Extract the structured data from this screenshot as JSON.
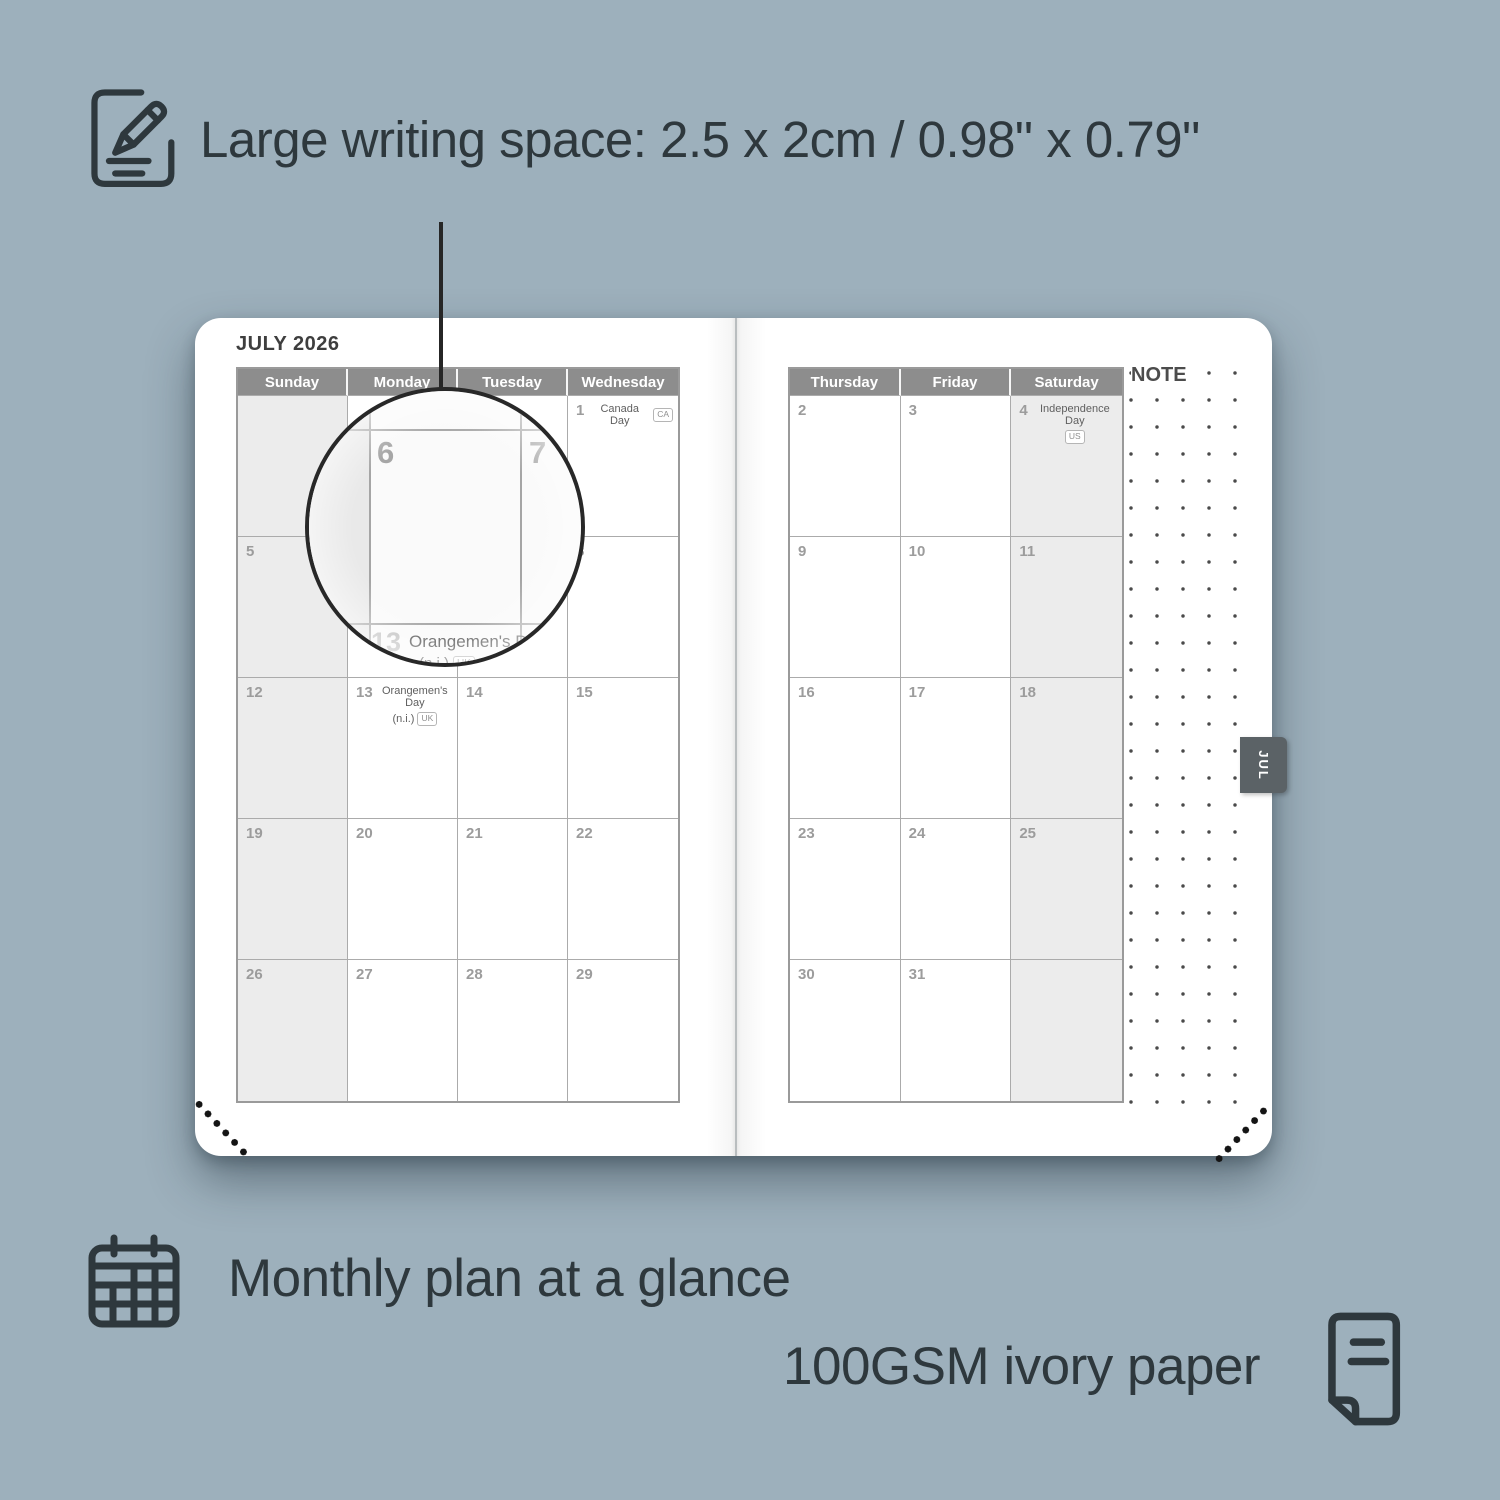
{
  "colors": {
    "background": "#9db0bc",
    "ink": "#2e383d",
    "header_bg": "#8d8d8d",
    "header_text": "#ffffff",
    "shaded_cell": "#ececec",
    "tab_bg": "#5b6266",
    "page": "#ffffff"
  },
  "annotations": {
    "writing_space": "Large writing space: 2.5 x 2cm / 0.98\" x 0.79\"",
    "monthly_plan": "Monthly plan at a glance",
    "paper": "100GSM ivory paper"
  },
  "planner": {
    "month_title": "JULY 2026",
    "note_label": "NOTE",
    "month_tab": "JUL",
    "left_page": {
      "headers": [
        "Sunday",
        "Monday",
        "Tuesday",
        "Wednesday"
      ],
      "shaded_column": 0,
      "rows": [
        [
          {},
          {},
          {},
          {
            "day": "1",
            "holiday": "Canada Day",
            "badge": "CA",
            "badge_inline": true
          }
        ],
        [
          {
            "day": "5"
          },
          {
            "day": "6"
          },
          {
            "day": "7"
          },
          {
            "day": "8"
          }
        ],
        [
          {
            "day": "12"
          },
          {
            "day": "13",
            "holiday": "Orangemen's Day",
            "holiday_sub": "(n.i.)",
            "badge": "UK"
          },
          {
            "day": "14"
          },
          {
            "day": "15"
          }
        ],
        [
          {
            "day": "19"
          },
          {
            "day": "20"
          },
          {
            "day": "21"
          },
          {
            "day": "22"
          }
        ],
        [
          {
            "day": "26"
          },
          {
            "day": "27"
          },
          {
            "day": "28"
          },
          {
            "day": "29"
          }
        ]
      ]
    },
    "right_page": {
      "headers": [
        "Thursday",
        "Friday",
        "Saturday"
      ],
      "shaded_column": 2,
      "rows": [
        [
          {
            "day": "2"
          },
          {
            "day": "3"
          },
          {
            "day": "4",
            "holiday": "Independence Day",
            "badge": "US"
          }
        ],
        [
          {
            "day": "9"
          },
          {
            "day": "10"
          },
          {
            "day": "11"
          }
        ],
        [
          {
            "day": "16"
          },
          {
            "day": "17"
          },
          {
            "day": "18"
          }
        ],
        [
          {
            "day": "23"
          },
          {
            "day": "24"
          },
          {
            "day": "25"
          }
        ],
        [
          {
            "day": "30"
          },
          {
            "day": "31"
          },
          {}
        ]
      ]
    },
    "magnifier": {
      "day_left": "6",
      "day_right": "7",
      "day_below": "13",
      "holiday": "Orangemen's Day",
      "holiday_sub": "(n.i.)",
      "badge": "UK"
    }
  }
}
